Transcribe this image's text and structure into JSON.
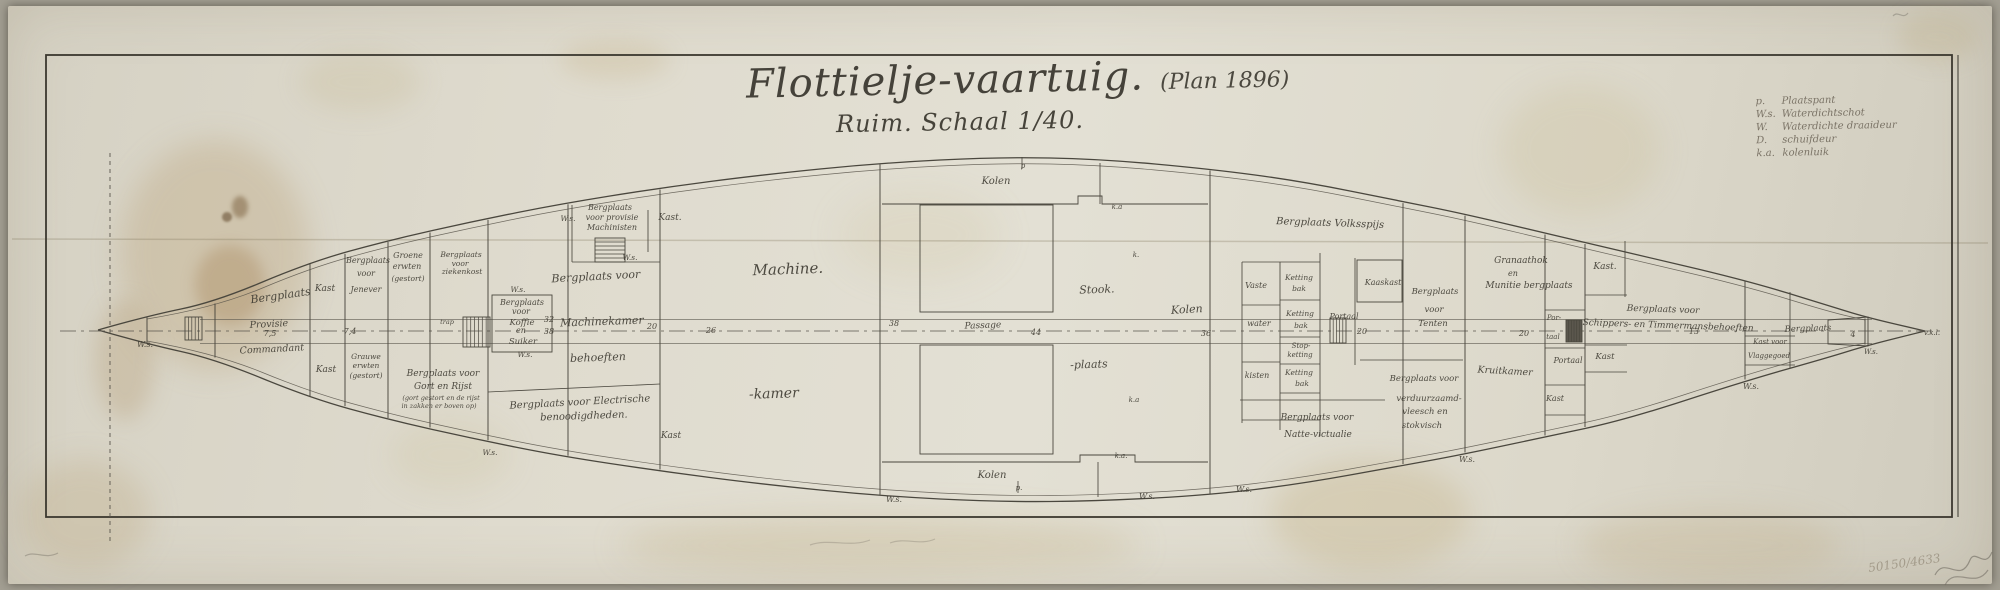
{
  "document": {
    "title_script": "Flottielje-vaartuig.",
    "title_plan": "(Plan 1896)",
    "subtitle": "Ruim.  Schaal 1/40."
  },
  "legend": {
    "rows": [
      {
        "abbr": "p.",
        "label": "Plaatspant"
      },
      {
        "abbr": "W.s.",
        "label": "Waterdichtschot"
      },
      {
        "abbr": "W.",
        "label": "Waterdichte draaideur"
      },
      {
        "abbr": "D.",
        "label": "schuifdeur"
      },
      {
        "abbr": "k.a.",
        "label": "kolenluik"
      }
    ]
  },
  "pencil_notes": {
    "archive_number": "50150/4633"
  },
  "plan": {
    "labels": [
      {
        "t": "W.s.",
        "x": 145,
        "y": 347,
        "s": 8,
        "n": "ws-label"
      },
      {
        "t": "Bergplaats",
        "x": 281,
        "y": 299,
        "s": 11,
        "r": -8
      },
      {
        "t": "Kast",
        "x": 325,
        "y": 291,
        "s": 9
      },
      {
        "t": "Provisie",
        "x": 269,
        "y": 327,
        "s": 9.5,
        "r": -3
      },
      {
        "t": "Commandant",
        "x": 272,
        "y": 352,
        "s": 9.5,
        "r": -3
      },
      {
        "t": "Kast",
        "x": 326,
        "y": 372,
        "s": 9
      },
      {
        "t": "Bergplaats",
        "x": 368,
        "y": 263,
        "s": 8
      },
      {
        "t": "voor",
        "x": 366,
        "y": 276,
        "s": 8
      },
      {
        "t": "Jenever",
        "x": 366,
        "y": 292,
        "s": 8
      },
      {
        "t": "Groene",
        "x": 408,
        "y": 258,
        "s": 8
      },
      {
        "t": "erwten",
        "x": 407,
        "y": 269,
        "s": 8
      },
      {
        "t": "(gestort)",
        "x": 408,
        "y": 281,
        "s": 7.5
      },
      {
        "t": "Grauwe",
        "x": 366,
        "y": 359,
        "s": 7.5
      },
      {
        "t": "erwten",
        "x": 366,
        "y": 368,
        "s": 7.5
      },
      {
        "t": "(gestort)",
        "x": 366,
        "y": 378,
        "s": 7.5
      },
      {
        "t": "Bergplaats voor",
        "x": 443,
        "y": 376,
        "s": 9
      },
      {
        "t": "Gort en Rijst",
        "x": 443,
        "y": 389,
        "s": 9
      },
      {
        "t": "(gort gestort en de rijst",
        "x": 441,
        "y": 400,
        "s": 6.5
      },
      {
        "t": "in zakken er boven op)",
        "x": 439,
        "y": 408,
        "s": 6.5
      },
      {
        "t": "Bergplaats",
        "x": 461,
        "y": 257,
        "s": 7.5
      },
      {
        "t": "voor",
        "x": 460,
        "y": 266,
        "s": 7.5
      },
      {
        "t": "ziekenkost",
        "x": 462,
        "y": 274,
        "s": 7.5
      },
      {
        "t": "trap",
        "x": 447,
        "y": 324,
        "s": 6.5
      },
      {
        "t": "W.s.",
        "x": 518,
        "y": 292,
        "s": 7.5,
        "n": "ws-label"
      },
      {
        "t": "Bergplaats",
        "x": 522,
        "y": 305,
        "s": 8
      },
      {
        "t": "voor",
        "x": 521,
        "y": 314,
        "s": 8
      },
      {
        "t": "Koffie",
        "x": 522,
        "y": 325,
        "s": 8.5
      },
      {
        "t": "en",
        "x": 521,
        "y": 333,
        "s": 8
      },
      {
        "t": "Suiker",
        "x": 523,
        "y": 344,
        "s": 8.5
      },
      {
        "t": "W.s.",
        "x": 525,
        "y": 357,
        "s": 7.5,
        "n": "ws-label"
      },
      {
        "t": "W.s.",
        "x": 568,
        "y": 221,
        "s": 7.5,
        "n": "ws-label"
      },
      {
        "t": "Bergplaats",
        "x": 610,
        "y": 210,
        "s": 8
      },
      {
        "t": "voor provisie",
        "x": 612,
        "y": 220,
        "s": 8
      },
      {
        "t": "Machinisten",
        "x": 612,
        "y": 230,
        "s": 8
      },
      {
        "t": "Kast.",
        "x": 670,
        "y": 220,
        "s": 9
      },
      {
        "t": "W.s.",
        "x": 630,
        "y": 260,
        "s": 7.5,
        "n": "ws-label"
      },
      {
        "t": "Bergplaats voor",
        "x": 596,
        "y": 280,
        "s": 11,
        "r": -3
      },
      {
        "t": "Machinekamer",
        "x": 602,
        "y": 325,
        "s": 11,
        "r": -2
      },
      {
        "t": "behoeften",
        "x": 598,
        "y": 361,
        "s": 11,
        "r": -2
      },
      {
        "t": "Bergplaats voor Electrische",
        "x": 580,
        "y": 405,
        "s": 10,
        "r": -3
      },
      {
        "t": "benoodigdheden.",
        "x": 584,
        "y": 419,
        "s": 10,
        "r": -2
      },
      {
        "t": "Kast",
        "x": 671,
        "y": 438,
        "s": 9
      },
      {
        "t": "W.s.",
        "x": 490,
        "y": 455,
        "s": 7.5,
        "n": "ws-label"
      },
      {
        "t": "Machine.",
        "x": 788,
        "y": 274,
        "s": 15,
        "r": -2
      },
      {
        "t": "-kamer",
        "x": 774,
        "y": 398,
        "s": 14,
        "r": -2
      },
      {
        "t": "Kolen",
        "x": 996,
        "y": 184,
        "s": 10
      },
      {
        "t": "p",
        "x": 1023,
        "y": 168,
        "s": 7,
        "n": "frame-mark"
      },
      {
        "t": "k.a",
        "x": 1117,
        "y": 209,
        "s": 7,
        "n": "hatch-mark"
      },
      {
        "t": "k.",
        "x": 1136,
        "y": 257,
        "s": 7,
        "n": "hatch-mark"
      },
      {
        "t": "Stook.",
        "x": 1097,
        "y": 293,
        "s": 11,
        "r": -2
      },
      {
        "t": "-plaats",
        "x": 1089,
        "y": 368,
        "s": 11,
        "r": -2
      },
      {
        "t": "Passage",
        "x": 983,
        "y": 328,
        "s": 9,
        "r": -2
      },
      {
        "t": "Kolen",
        "x": 1187,
        "y": 313,
        "s": 11,
        "r": -3
      },
      {
        "t": "k.a",
        "x": 1134,
        "y": 402,
        "s": 7,
        "n": "hatch-mark"
      },
      {
        "t": "k.a.",
        "x": 1121,
        "y": 458,
        "s": 7,
        "n": "hatch-mark"
      },
      {
        "t": "Kolen",
        "x": 992,
        "y": 478,
        "s": 10
      },
      {
        "t": "p.",
        "x": 1019,
        "y": 490,
        "s": 7,
        "n": "frame-mark"
      },
      {
        "t": "W.s.",
        "x": 894,
        "y": 502,
        "s": 8,
        "n": "ws-label"
      },
      {
        "t": "W.s.",
        "x": 1147,
        "y": 499,
        "s": 8,
        "n": "ws-label"
      },
      {
        "t": "Bergplaats Volksspijs",
        "x": 1330,
        "y": 226,
        "s": 10,
        "r": 2
      },
      {
        "t": "Vaste",
        "x": 1256,
        "y": 288,
        "s": 8
      },
      {
        "t": "water",
        "x": 1259,
        "y": 326,
        "s": 8
      },
      {
        "t": "kisten",
        "x": 1257,
        "y": 378,
        "s": 8
      },
      {
        "t": "Ketting",
        "x": 1299,
        "y": 280,
        "s": 7.5
      },
      {
        "t": "bak",
        "x": 1299,
        "y": 291,
        "s": 7.5
      },
      {
        "t": "Ketting",
        "x": 1300,
        "y": 316,
        "s": 7.5
      },
      {
        "t": "bak",
        "x": 1301,
        "y": 328,
        "s": 7.5
      },
      {
        "t": "Stop-",
        "x": 1301,
        "y": 348,
        "s": 7
      },
      {
        "t": "ketting",
        "x": 1300,
        "y": 357,
        "s": 7
      },
      {
        "t": "Ketting",
        "x": 1299,
        "y": 375,
        "s": 7.5
      },
      {
        "t": "bak",
        "x": 1302,
        "y": 386,
        "s": 7.5
      },
      {
        "t": "Portaal",
        "x": 1344,
        "y": 319,
        "s": 8
      },
      {
        "t": "Kaaskast",
        "x": 1383,
        "y": 285,
        "s": 8
      },
      {
        "t": "Bergplaats",
        "x": 1435,
        "y": 294,
        "s": 8.5
      },
      {
        "t": "voor",
        "x": 1434,
        "y": 312,
        "s": 8.5
      },
      {
        "t": "Tenten",
        "x": 1433,
        "y": 326,
        "s": 8.5
      },
      {
        "t": "Granaathok",
        "x": 1521,
        "y": 263,
        "s": 9
      },
      {
        "t": "en",
        "x": 1513,
        "y": 276,
        "s": 8
      },
      {
        "t": "Munitie bergplaats",
        "x": 1529,
        "y": 288,
        "s": 9
      },
      {
        "t": "Kast.",
        "x": 1605,
        "y": 269,
        "s": 9
      },
      {
        "t": "Bergplaats voor",
        "x": 1663,
        "y": 312,
        "s": 9,
        "r": 2
      },
      {
        "t": "Schippers- en Timmermansbehoeften",
        "x": 1668,
        "y": 328,
        "s": 9,
        "r": 2
      },
      {
        "t": "Kruitkamer",
        "x": 1505,
        "y": 374,
        "s": 9.5,
        "r": 3
      },
      {
        "t": "Por-",
        "x": 1554,
        "y": 320,
        "s": 7
      },
      {
        "t": "taal",
        "x": 1553,
        "y": 339,
        "s": 7
      },
      {
        "t": "Portaal",
        "x": 1568,
        "y": 363,
        "s": 8
      },
      {
        "t": "Kast",
        "x": 1605,
        "y": 359,
        "s": 8.5
      },
      {
        "t": "Kast",
        "x": 1555,
        "y": 401,
        "s": 8
      },
      {
        "t": "Bergplaats voor",
        "x": 1424,
        "y": 381,
        "s": 8.5
      },
      {
        "t": "verduurzaamd-",
        "x": 1429,
        "y": 401,
        "s": 8.5
      },
      {
        "t": "vleesch en",
        "x": 1425,
        "y": 414,
        "s": 8.5
      },
      {
        "t": "stokvisch",
        "x": 1422,
        "y": 428,
        "s": 8.5
      },
      {
        "t": "Bergplaats voor",
        "x": 1317,
        "y": 420,
        "s": 9
      },
      {
        "t": "Natte-victualie",
        "x": 1318,
        "y": 437,
        "s": 9
      },
      {
        "t": "W.s.",
        "x": 1467,
        "y": 462,
        "s": 8,
        "n": "ws-label"
      },
      {
        "t": "W.s.",
        "x": 1244,
        "y": 492,
        "s": 8,
        "n": "ws-label"
      },
      {
        "t": "Kast voor",
        "x": 1770,
        "y": 344,
        "s": 7
      },
      {
        "t": "Vlaggegoed",
        "x": 1769,
        "y": 358,
        "s": 7
      },
      {
        "t": "Bergplaats",
        "x": 1808,
        "y": 331,
        "s": 8.5,
        "r": -2
      },
      {
        "t": "W.s.",
        "x": 1871,
        "y": 354,
        "s": 7,
        "n": "ws-label"
      },
      {
        "t": "W.s.",
        "x": 1751,
        "y": 389,
        "s": 8,
        "n": "ws-label"
      },
      {
        "t": "v.k.l.",
        "x": 1932,
        "y": 335,
        "s": 7,
        "n": "tip-mark"
      }
    ],
    "dimensions": [
      {
        "v": "7,5",
        "x": 270,
        "y": 336
      },
      {
        "v": "7,4",
        "x": 350,
        "y": 334
      },
      {
        "v": "32",
        "x": 549,
        "y": 322
      },
      {
        "v": "38",
        "x": 549,
        "y": 334
      },
      {
        "v": "20",
        "x": 652,
        "y": 329
      },
      {
        "v": "26",
        "x": 711,
        "y": 333
      },
      {
        "v": "38",
        "x": 894,
        "y": 326
      },
      {
        "v": "44",
        "x": 1036,
        "y": 335
      },
      {
        "v": "36",
        "x": 1206,
        "y": 336
      },
      {
        "v": "20",
        "x": 1362,
        "y": 334
      },
      {
        "v": "20",
        "x": 1524,
        "y": 336
      },
      {
        "v": "13",
        "x": 1694,
        "y": 334
      },
      {
        "v": "4",
        "x": 1853,
        "y": 337
      }
    ]
  }
}
